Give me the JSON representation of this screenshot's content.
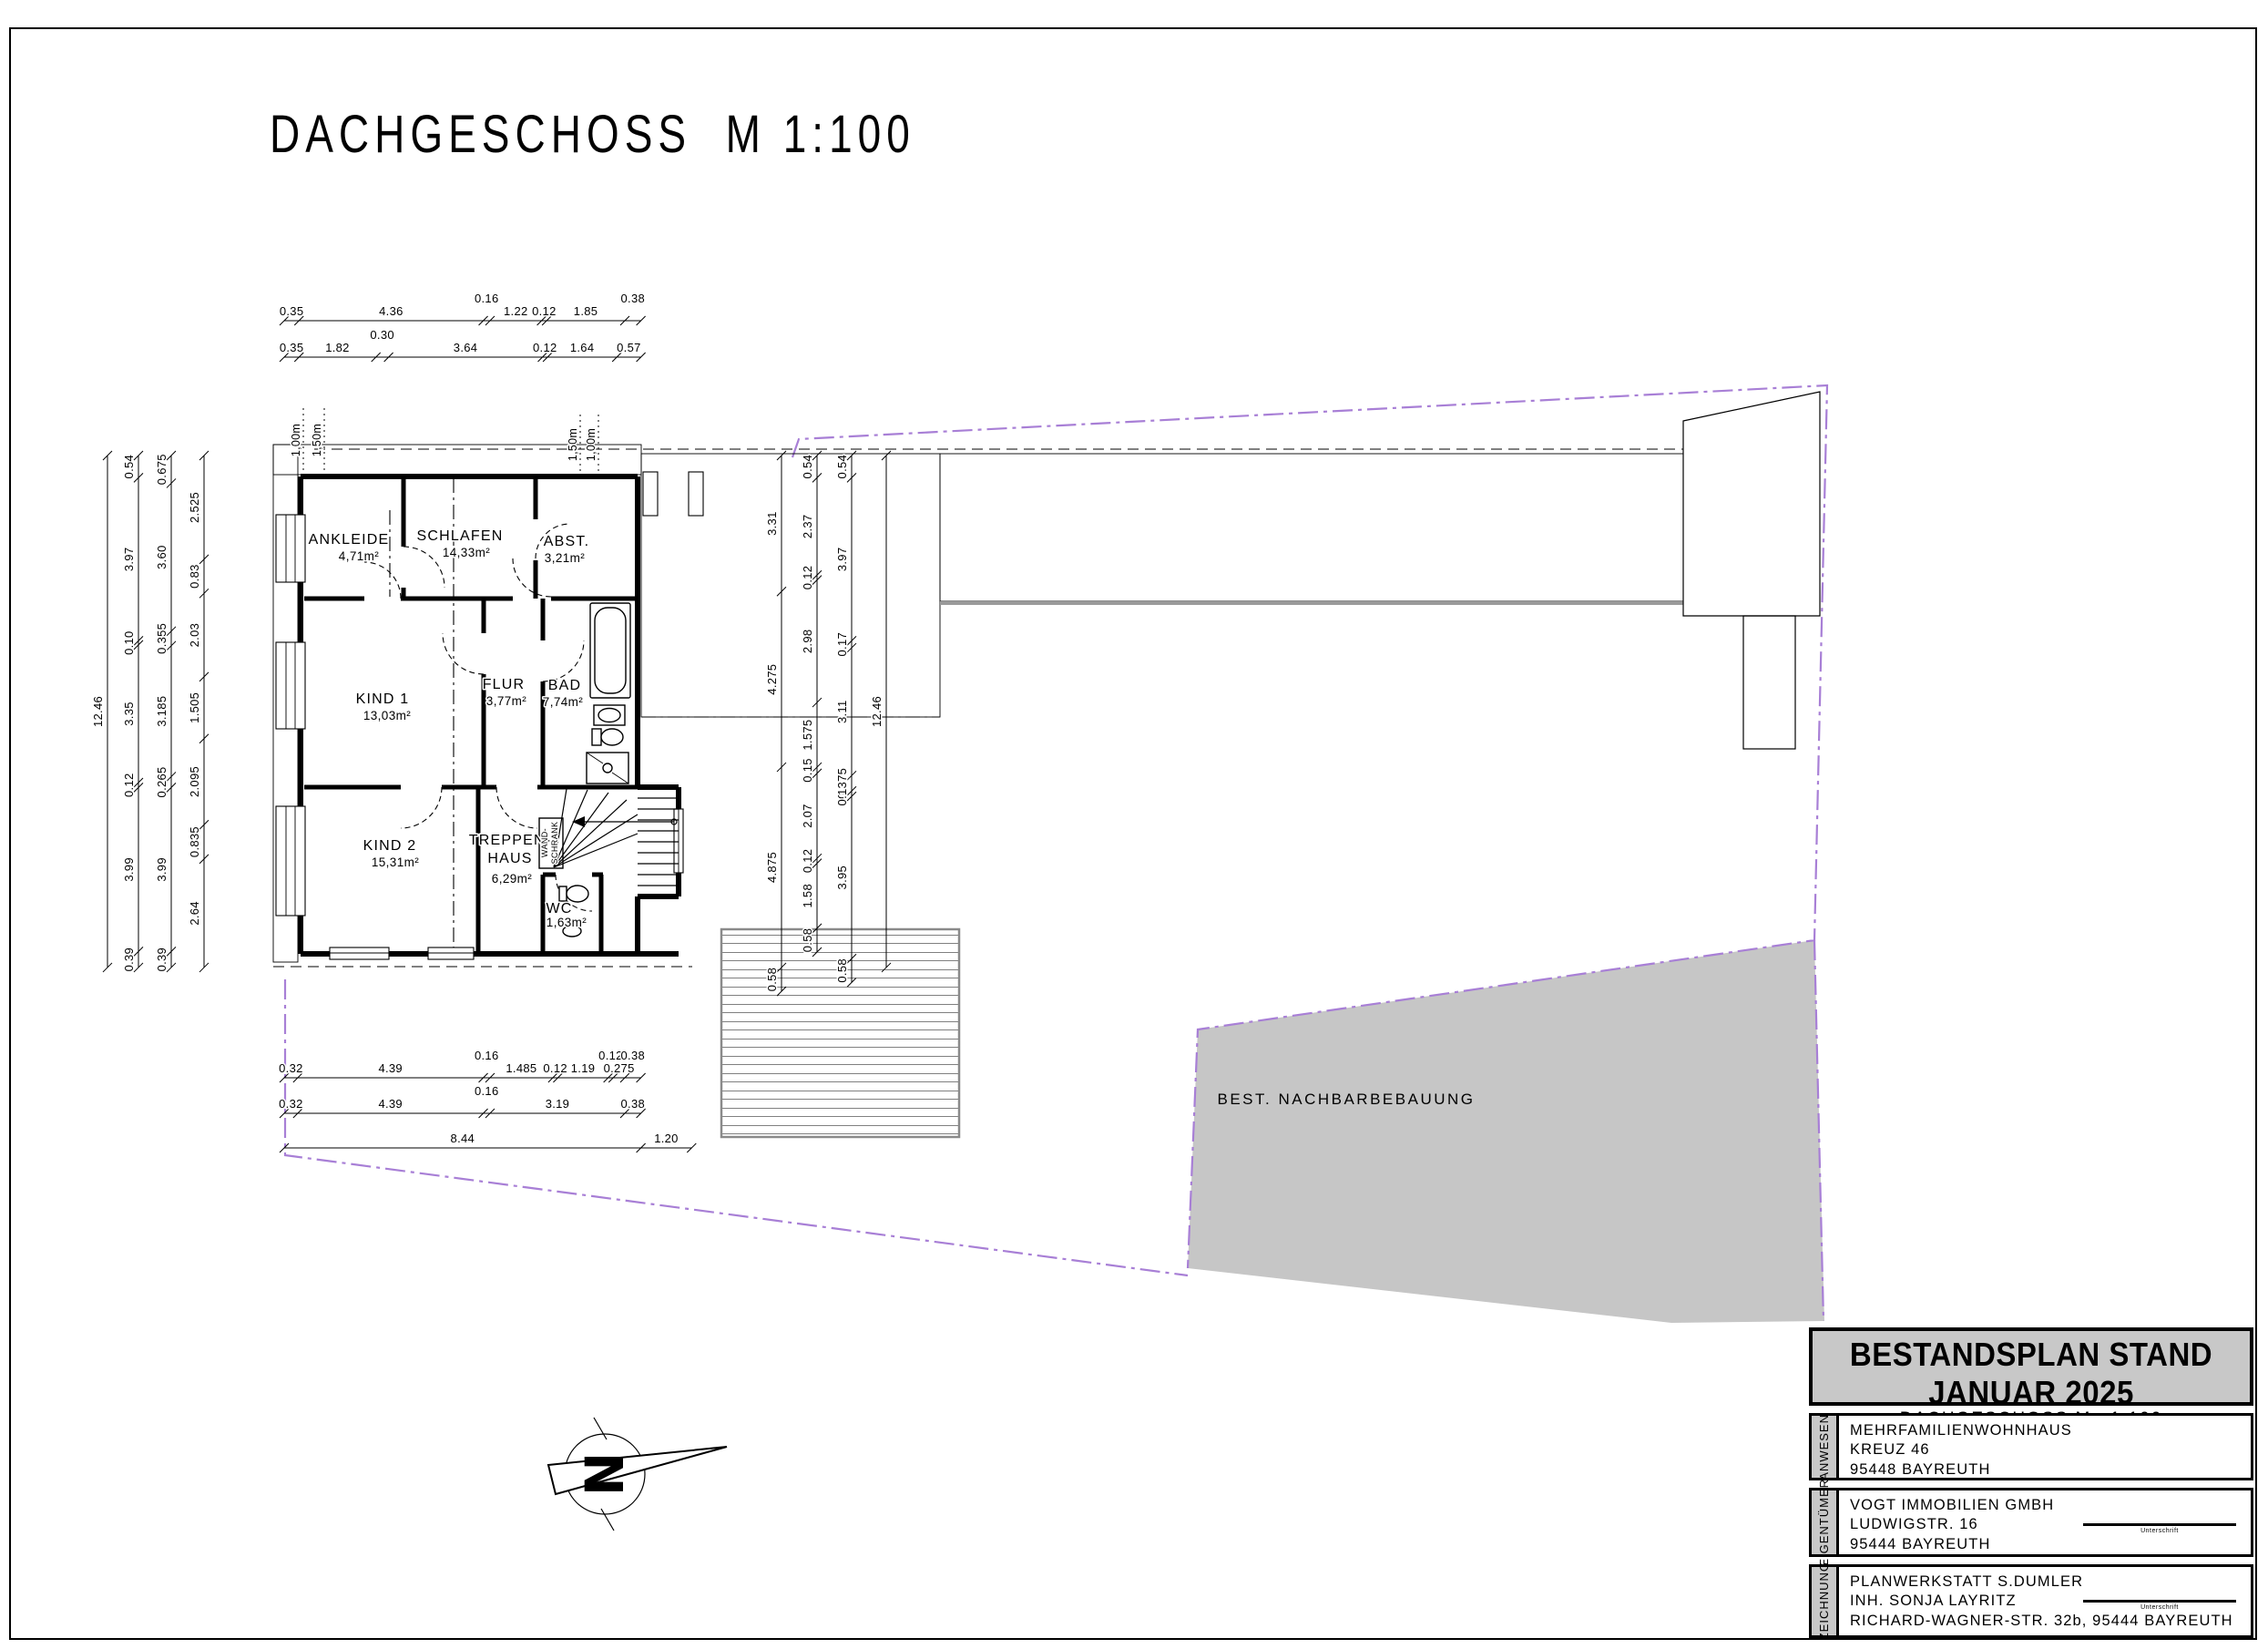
{
  "sheet": {
    "title": "DACHGESCHOSS  M 1:100"
  },
  "rooms": {
    "ankleide": {
      "name": "ANKLEIDE",
      "area": "4,71m²"
    },
    "schlafen": {
      "name": "SCHLAFEN",
      "area": "14,33m²"
    },
    "abst": {
      "name": "ABST.",
      "area": "3,21m²"
    },
    "kind1": {
      "name": "KIND 1",
      "area": "13,03m²"
    },
    "flur": {
      "name": "FLUR",
      "area": "3,77m²"
    },
    "bad": {
      "name": "BAD",
      "area": "7,74m²"
    },
    "kind2": {
      "name": "KIND 2",
      "area": "15,31m²"
    },
    "treppenhaus": {
      "name1": "TREPPEN-",
      "name2": "HAUS",
      "area": "6,29m²"
    },
    "wc": {
      "name": "WC",
      "area": "1,63m²"
    },
    "wandschrank": {
      "line1": "WAND-",
      "line2": "SCHRANK"
    }
  },
  "annotations": {
    "neighbor": "BEST. NACHBARBEBAUUNG",
    "north_letter": "N",
    "knee": {
      "l_outer": "1,00m",
      "l_inner": "1,50m",
      "r_inner": "1,50m",
      "r_outer": "1,00m"
    }
  },
  "chains": {
    "left_total": {
      "values": [
        "12.46"
      ]
    },
    "left_a": {
      "values": [
        "0.54",
        "3.97",
        "0.10",
        "3.35",
        "0.12",
        "3.99",
        "0.39"
      ]
    },
    "left_b": {
      "values": [
        "0.675",
        "3.60",
        "0.355",
        "3.185",
        "0.265",
        "3.99",
        "0.39"
      ]
    },
    "left_c": {
      "values": [
        "2.525",
        "0.83",
        "2.03",
        "1.505",
        "2.095",
        "0.835",
        "2.64"
      ]
    },
    "top_a": {
      "values": [
        "0.35",
        "4.36",
        "0.16",
        "1.22",
        "0.12",
        "1.85",
        "0.38"
      ]
    },
    "top_b": {
      "values": [
        "0.35",
        "1.82",
        "0.30",
        "3.64",
        "0.12",
        "1.64",
        "0.57"
      ]
    },
    "bottom_a": {
      "values": [
        "0.32",
        "4.39",
        "0.16",
        "1.485",
        "0.12",
        "1.19",
        "0.12",
        "0.275",
        "0.38"
      ]
    },
    "bottom_b": {
      "values": [
        "0.32",
        "4.39",
        "0.16",
        "3.19",
        "0.38"
      ]
    },
    "bottom_c": {
      "values": [
        "8.44",
        "1.20"
      ]
    },
    "mid_a": {
      "values": [
        "3.31",
        "4.275",
        "4.875",
        "0.58"
      ]
    },
    "mid_b": {
      "values": [
        "0.54",
        "2.37",
        "0.12",
        "2.98",
        "1.575",
        "0.15",
        "2.07",
        "0.12",
        "1.58",
        "0.58"
      ]
    },
    "mid_c": {
      "values": [
        "0.54",
        "3.97",
        "0.17",
        "3.11",
        "0.375",
        "0.13",
        "3.95",
        "0.58"
      ]
    },
    "mid_total": {
      "values": [
        "12.46"
      ]
    }
  },
  "titleblock": {
    "header": "BESTANDSPLAN STAND JANUAR 2025",
    "subheader": "DACHGESCHOSS  M= 1:100",
    "sections": [
      {
        "label": "ANWESEN",
        "lines": [
          "MEHRFAMILIENWOHNHAUS",
          "KREUZ 46",
          "95448 BAYREUTH"
        ]
      },
      {
        "label": "EIGENTÜMER",
        "lines": [
          "VOGT IMMOBILIEN GMBH",
          "LUDWIGSTR. 16",
          "95444 BAYREUTH"
        ],
        "sig_label": "Unterschrift"
      },
      {
        "label": "ZEICHNUNG",
        "lines": [
          "PLANWERKSTATT S.DUMLER",
          "INH. SONJA LAYRITZ",
          "RICHARD-WAGNER-STR. 32b, 95444 BAYREUTH"
        ],
        "sig_label": "Unterschrift"
      }
    ]
  },
  "colors": {
    "boundary": "#a87fd6",
    "gray_fill": "#c6c6c6",
    "line": "#000000"
  }
}
